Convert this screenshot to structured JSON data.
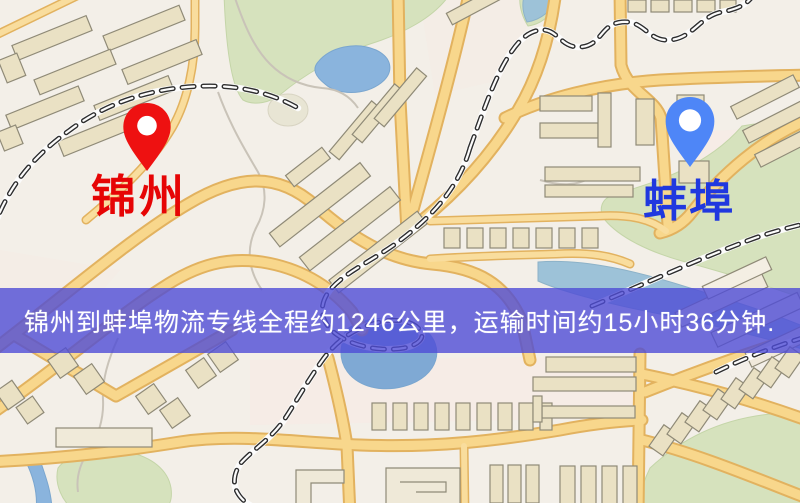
{
  "window": {
    "width_px": 800,
    "height_px": 503,
    "kind": "map-screenshot"
  },
  "origin": {
    "name": "锦州",
    "pin_color": "#ee1111",
    "label_color": "#e60505"
  },
  "destination": {
    "name": "蚌埠",
    "pin_color": "#4e86f7",
    "label_color": "#2038df"
  },
  "banner": {
    "text": "锦州到蚌埠物流专线全程约1246公里，运输时间约15小时36分钟.",
    "background_color": "#4f4cd6",
    "text_color": "#ffffff",
    "distance_km": "1246",
    "duration": "15小时36分钟"
  },
  "map": {
    "description": "road map with streets, railways, buildings, parks and water",
    "palette": {
      "land": "#f3efe8",
      "road_fill": "#f8d78c",
      "road_casing": "#e2b25f",
      "building_fill": "#eae1c4",
      "building_stroke": "#8f8a77",
      "green_area": "#d6e2bd",
      "water": "#8ab4dd",
      "railway": "#2e2e2e"
    }
  }
}
